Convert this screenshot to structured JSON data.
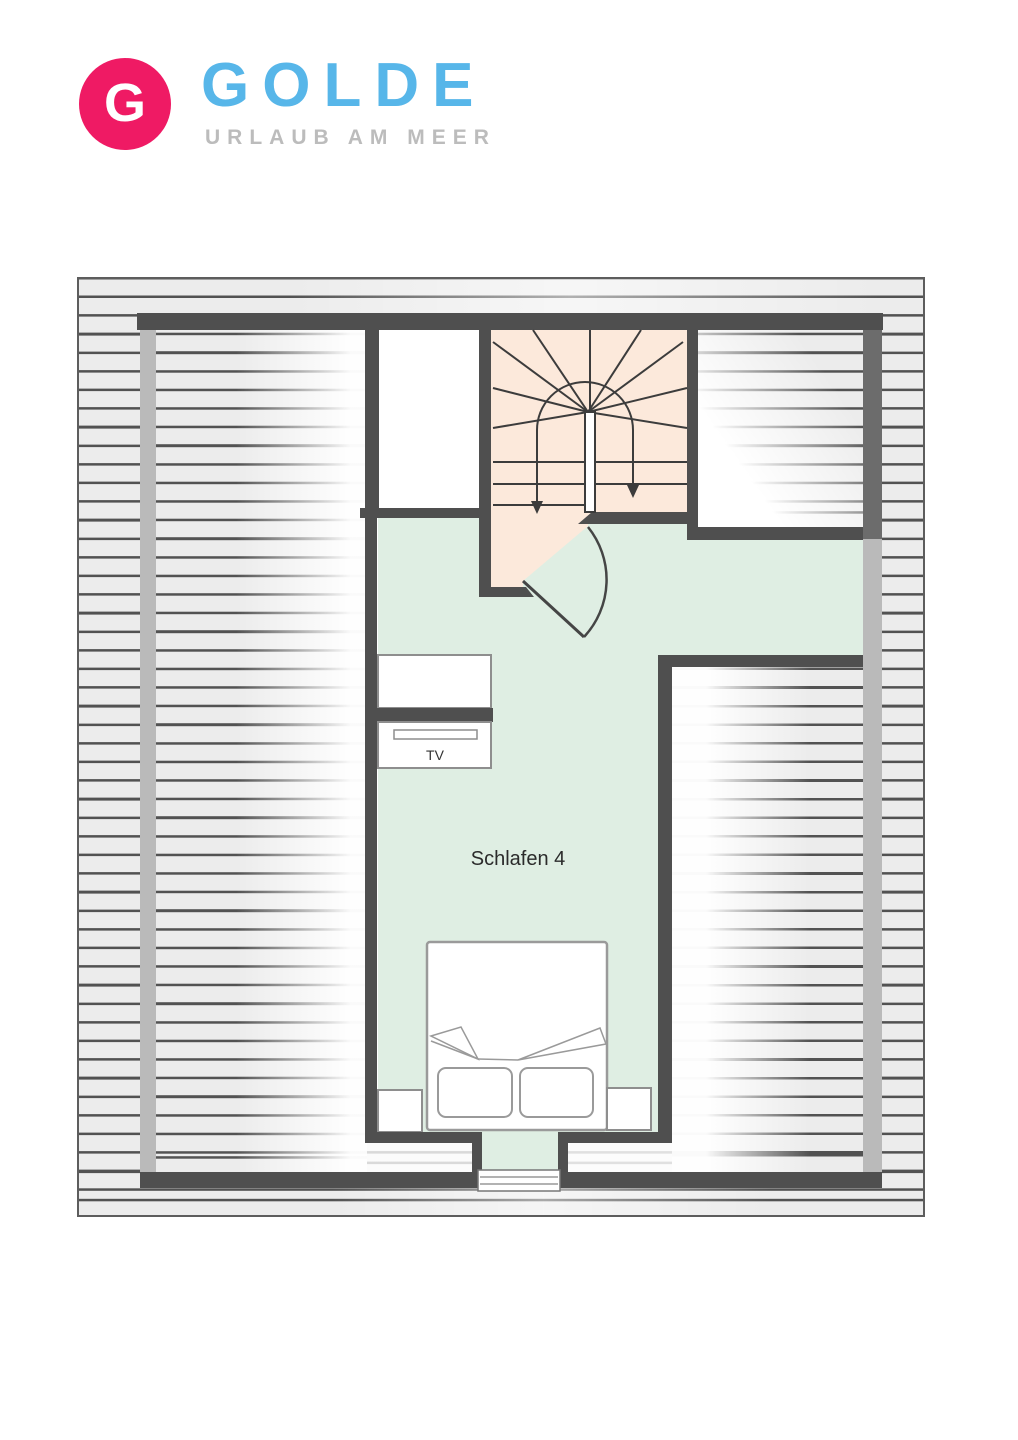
{
  "logo": {
    "badge_letter": "G",
    "brand_name": "GOLDE",
    "tagline": "URLAUB AM MEER"
  },
  "floor_plan": {
    "bedroom_label": "Schlafen 4",
    "tv_label": "TV"
  },
  "colors": {
    "brand_pink": "#ef1a64",
    "brand_blue": "#57b6e9",
    "tagline_gray": "#bcbcbc",
    "wall_dark": "#4f4f4f",
    "room_green": "#dfeee3",
    "stair_peach": "#fce9db",
    "hatch_line": "#525252",
    "hatch_gap": "#ececec"
  }
}
